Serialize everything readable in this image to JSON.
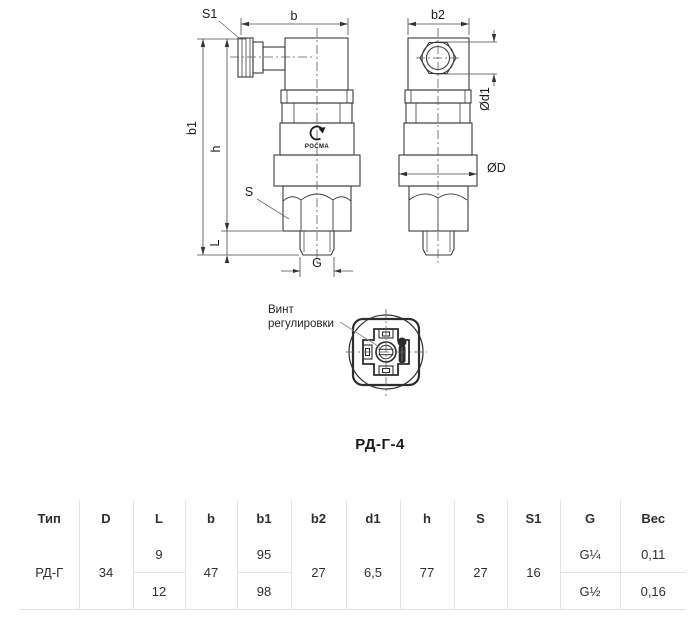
{
  "drawing": {
    "title": "РД-Г-4",
    "side_view": {
      "dim_s1": "S1",
      "dim_b": "b",
      "dim_b1": "b1",
      "dim_h": "h",
      "dim_s": "S",
      "dim_l": "L",
      "dim_g": "G",
      "logo_text": "РОСМА"
    },
    "front_view": {
      "dim_b2": "b2",
      "dim_d1": "Ød1",
      "dim_D": "ØD"
    },
    "bottom_view": {
      "label_line1": "Винт",
      "label_line2": "регулировки"
    }
  },
  "table": {
    "headers": [
      "Тип",
      "D",
      "L",
      "b",
      "b1",
      "b2",
      "d1",
      "h",
      "S",
      "S1",
      "G",
      "Вес"
    ],
    "rows": {
      "type": "РД-Г",
      "D": "34",
      "L1": "9",
      "L2": "12",
      "b": "47",
      "b1_1": "95",
      "b1_2": "98",
      "b2": "27",
      "d1": "6,5",
      "h": "77",
      "S": "27",
      "S1": "16",
      "G1": "G¼",
      "G2": "G½",
      "weight1": "0,11",
      "weight2": "0,16"
    }
  },
  "colors": {
    "line": "#3b3b3b",
    "table_border": "#e4e4e8",
    "text": "#2f2f33"
  }
}
